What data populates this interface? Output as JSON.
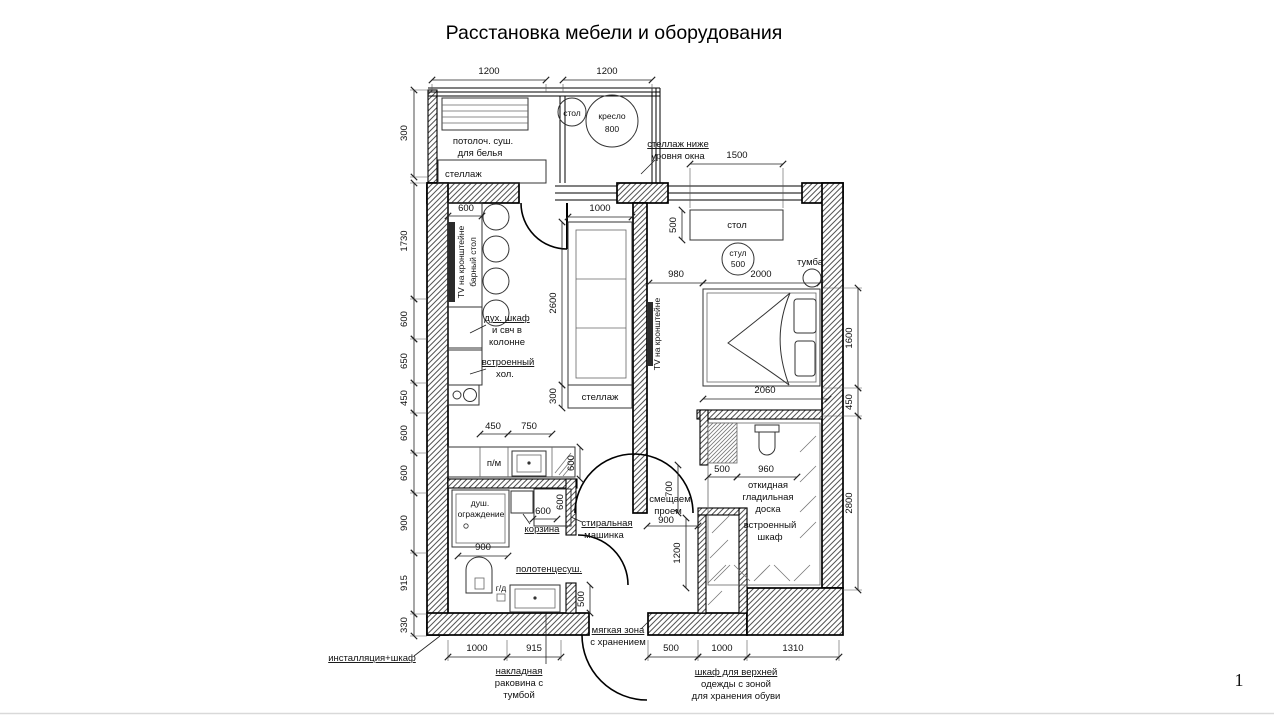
{
  "title": "Расстановка мебели и оборудования",
  "page_number": "1",
  "plan": {
    "balcony": {
      "dim_left": "1200",
      "dim_right": "1200",
      "dim_depth": "300",
      "dryer_line1": "потолоч. суш.",
      "dryer_line2": "для белья",
      "shelf": "стеллаж",
      "table": "стол",
      "armchair": "кресло",
      "armchair_size": "800",
      "note_line1": "стеллаж ниже",
      "note_line2": "уровня окна"
    },
    "kitchen": {
      "tv": "TV на кронштейне",
      "bar_table": "барный стол",
      "bar_width": "600",
      "oven_line1": "дух. шкаф",
      "oven_line2": "и свч в",
      "oven_line3": "колонне",
      "fridge_line1": "встроенный",
      "fridge_line2": "хол.",
      "dishwasher": "п/м",
      "dim_450": "450",
      "dim_750": "750",
      "dim_600": "600"
    },
    "living": {
      "sofa_width": "1000",
      "sofa_length": "2600",
      "shelf": "стеллаж",
      "shelf_depth": "300"
    },
    "bedroom": {
      "window_dim": "1500",
      "desk": "стол",
      "desk_depth": "500",
      "chair": "стул",
      "chair_size": "500",
      "nightstand": "тумба",
      "tv": "TV на кронштейне",
      "dim_980": "980",
      "dim_2000": "2000",
      "dim_2060": "2060"
    },
    "bathroom": {
      "shower_line1": "душ.",
      "shower_line2": "ограждение",
      "shower_width": "900",
      "basket": "корзина",
      "basket_dim": "600",
      "washer_line1": "стиральная",
      "washer_line2": "машинка",
      "washer_dim": "600",
      "towel_dryer": "полотенцесуш.",
      "hyg_shower": "г/д",
      "sink_line1": "накладная",
      "sink_line2": "раковина с",
      "sink_line3": "тумбой",
      "installation": "инсталляция+шкаф",
      "dim_1000": "1000",
      "dim_915": "915",
      "dim_500": "500"
    },
    "hallway": {
      "opening_line1": "смещаем",
      "opening_line2": "проем",
      "opening_dim": "900",
      "dim_700": "700",
      "dim_1200": "1200",
      "soft_zone_line1": "мягкая зона",
      "soft_zone_line2": "с хранением"
    },
    "wardrobe": {
      "dim_500": "500",
      "dim_960": "960",
      "ironing_line1": "откидная",
      "ironing_line2": "гладильная",
      "ironing_line3": "доска",
      "builtin_line1": "встроенный",
      "builtin_line2": "шкаф",
      "note_line1": "шкаф для верхней",
      "note_line2": "одежды с зоной",
      "note_line3": "для хранения обуви",
      "dim_bottom_500": "500",
      "dim_bottom_1000": "1000",
      "dim_bottom_1310": "1310"
    },
    "dims_left": [
      "300",
      "1730",
      "600",
      "650",
      "450",
      "600",
      "600",
      "900",
      "915",
      "330"
    ],
    "dims_right": [
      "1600",
      "450",
      "2800"
    ]
  }
}
